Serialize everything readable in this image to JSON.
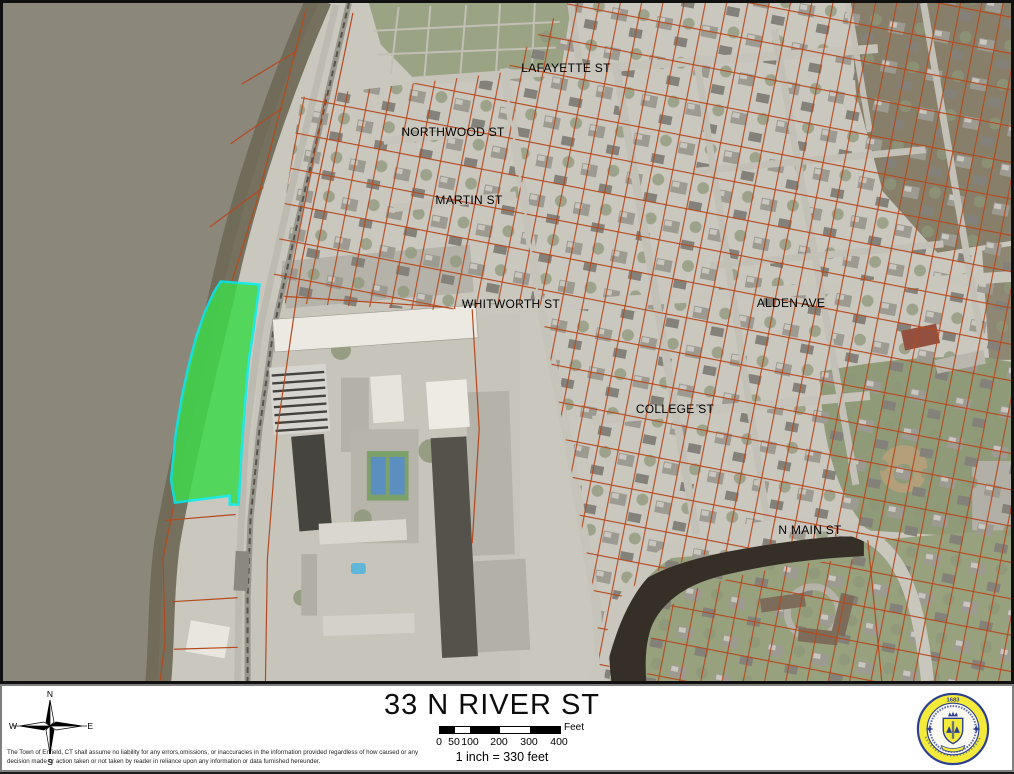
{
  "map": {
    "street_labels": [
      {
        "text": "LAFAYETTE ST"
      },
      {
        "text": "NORTHWOOD ST"
      },
      {
        "text": "MARTIN ST"
      },
      {
        "text": "WHITWORTH ST"
      },
      {
        "text": "ALDEN AVE"
      },
      {
        "text": "COLLEGE ST"
      },
      {
        "text": "N MAIN ST"
      }
    ],
    "highlight_parcel": {
      "fill": "#3fd94b",
      "outline": "#00efef"
    },
    "parcel_line_color": "#b5491d"
  },
  "footer": {
    "title": "33 N RIVER ST",
    "scale_ticks": [
      "0",
      "50",
      "100",
      "200",
      "300",
      "400"
    ],
    "scale_unit": "Feet",
    "scale_text": "1 inch = 330 feet",
    "compass": {
      "n": "N",
      "s": "S",
      "e": "E",
      "w": "W"
    },
    "disclaimer_line1": "The Town of Enfield, CT shall assume no liability for any errors,omissions, or inaccuracies in the information provided regardless of how caused or any",
    "disclaimer_line2": "decision made or action taken or not taken by reader in reliance upon any information or data furnished hereunder.",
    "seal_year": "1683"
  }
}
